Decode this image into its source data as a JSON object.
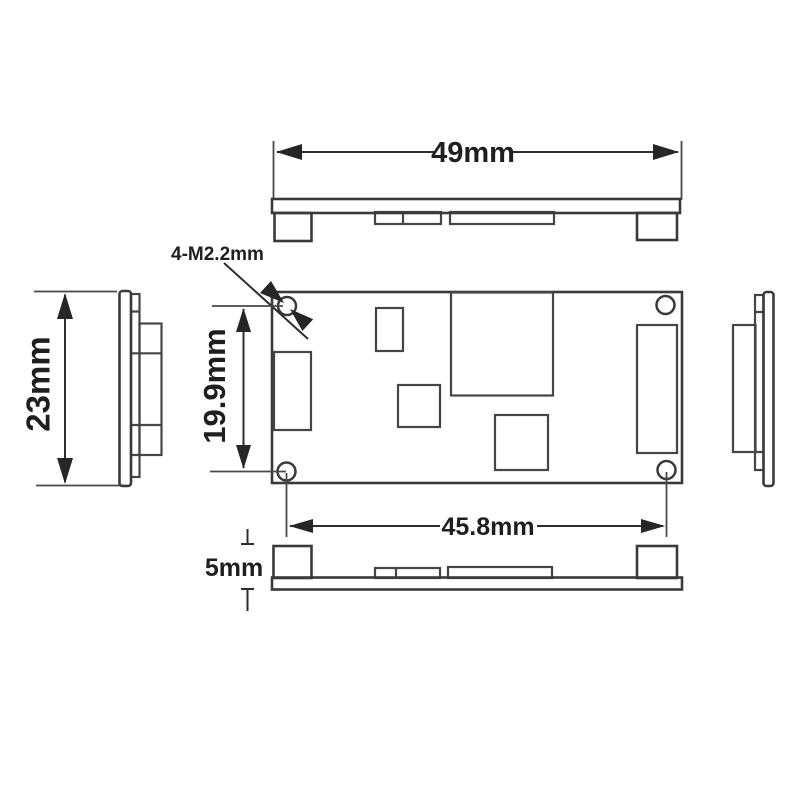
{
  "drawing": {
    "type": "mechanical-dimension-diagram",
    "subject": "pcb-module-outline",
    "background_color": "#ffffff",
    "line_color": "#3a3a3a",
    "text_color": "#1f1f1f",
    "labels": {
      "board_width": "49mm",
      "side_height": "23mm",
      "hole_pitch_vertical": "19.9mm",
      "hole_pitch_horizontal": "45.8mm",
      "standoff_height": "5mm",
      "mounting_holes": "4-M2.2mm"
    }
  }
}
